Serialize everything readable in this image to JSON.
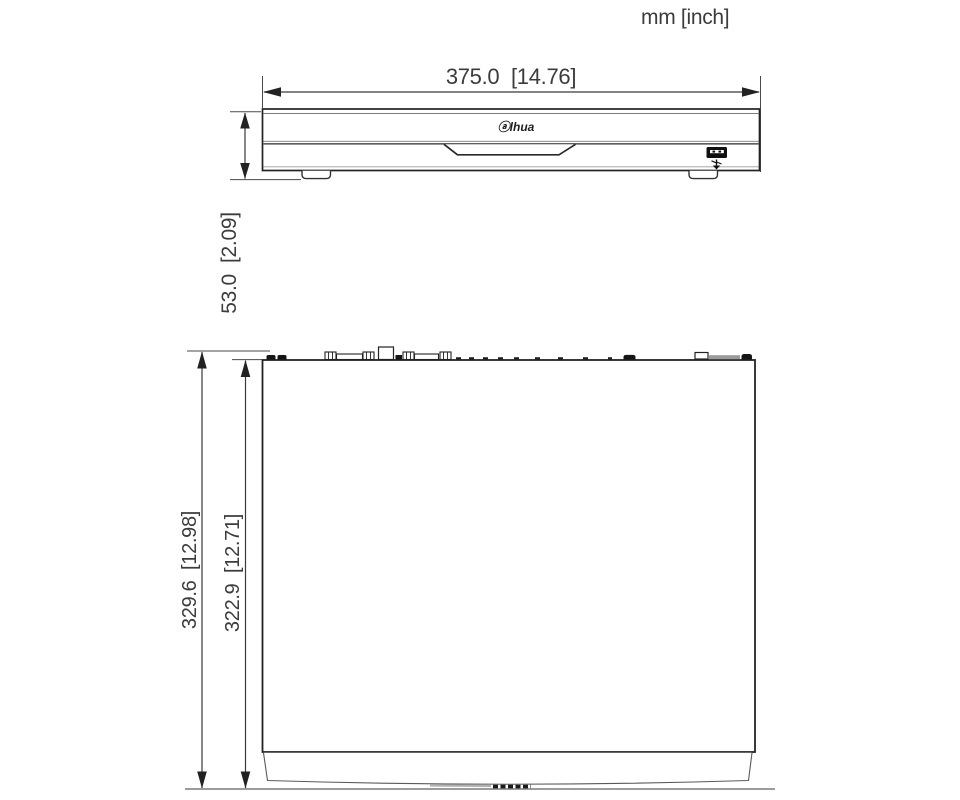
{
  "title": "NVR chassis dimension drawing",
  "units_label": "mm [inch]",
  "logo_text": "ⓐlhua",
  "front_view": {
    "width_label": "375.0  [14.76]",
    "height_label": "53.0  [2.09]"
  },
  "top_view": {
    "overall_depth_label": "329.6  [12.98]",
    "body_depth_label": "322.9  [12.71]"
  },
  "dimensions": {
    "front_width_mm": 375.0,
    "front_width_in": 14.76,
    "front_height_mm": 53.0,
    "front_height_in": 2.09,
    "top_overall_depth_mm": 329.6,
    "top_overall_depth_in": 12.98,
    "top_body_depth_mm": 322.9,
    "top_body_depth_in": 12.71
  },
  "colors": {
    "line": "#2b2b2b",
    "dim_line": "#4a4a4a",
    "text": "#3c3c3c",
    "gray_detail": "#9a9a9a",
    "background": "#ffffff"
  }
}
